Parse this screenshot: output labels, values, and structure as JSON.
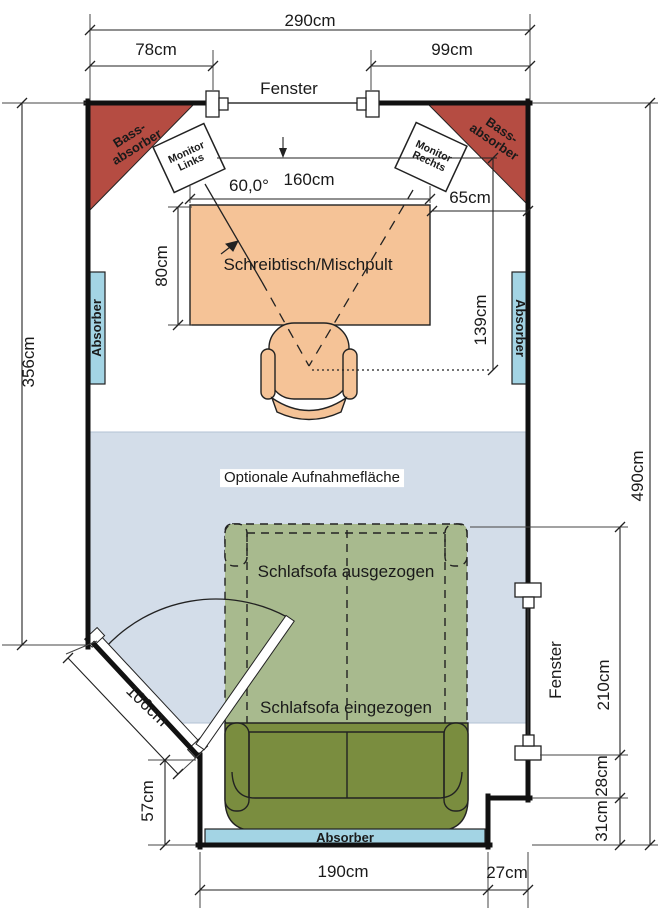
{
  "labels": {
    "window_top": "Fenster",
    "window_right": "Fenster",
    "bass_absorber_left": "Bass-\nabsorber",
    "bass_absorber_right": "Bass-\nabsorber",
    "monitor_left": "Monitor\nLinks",
    "monitor_right": "Monitor\nRechts",
    "desk": "Schreibtisch/Mischpult",
    "absorber_left": "Absorber",
    "absorber_right": "Absorber",
    "absorber_bottom": "Absorber",
    "recording_area": "Optionale Aufnahmefläche",
    "sofa_extended": "Schlafsofa ausgezogen",
    "sofa_retracted": "Schlafsofa eingezogen"
  },
  "dimensions": {
    "room_width": "290cm",
    "left_wall_to_window": "78cm",
    "window_to_right_wall": "99cm",
    "listening_angle": "60,0°",
    "monitor_span": "160cm",
    "desk_to_wall": "65cm",
    "desk_depth": "80cm",
    "listening_distance": "139cm",
    "left_height": "356cm",
    "right_height": "490cm",
    "right_window": "210cm",
    "step_upper": "28cm",
    "step_lower": "31cm",
    "bottom_step": "27cm",
    "bottom_width": "190cm",
    "lower_left_wall": "57cm",
    "door_wall": "106cm"
  },
  "colors": {
    "wall": "#111111",
    "bass_absorber": "#b54c42",
    "desk": "#f5c397",
    "chair": "#f5c397",
    "absorber": "#a3d4e4",
    "recording_area": "#d3dde9",
    "sofa_extended": "#a8ba8e",
    "sofa_retracted": "#7a8d3f"
  }
}
